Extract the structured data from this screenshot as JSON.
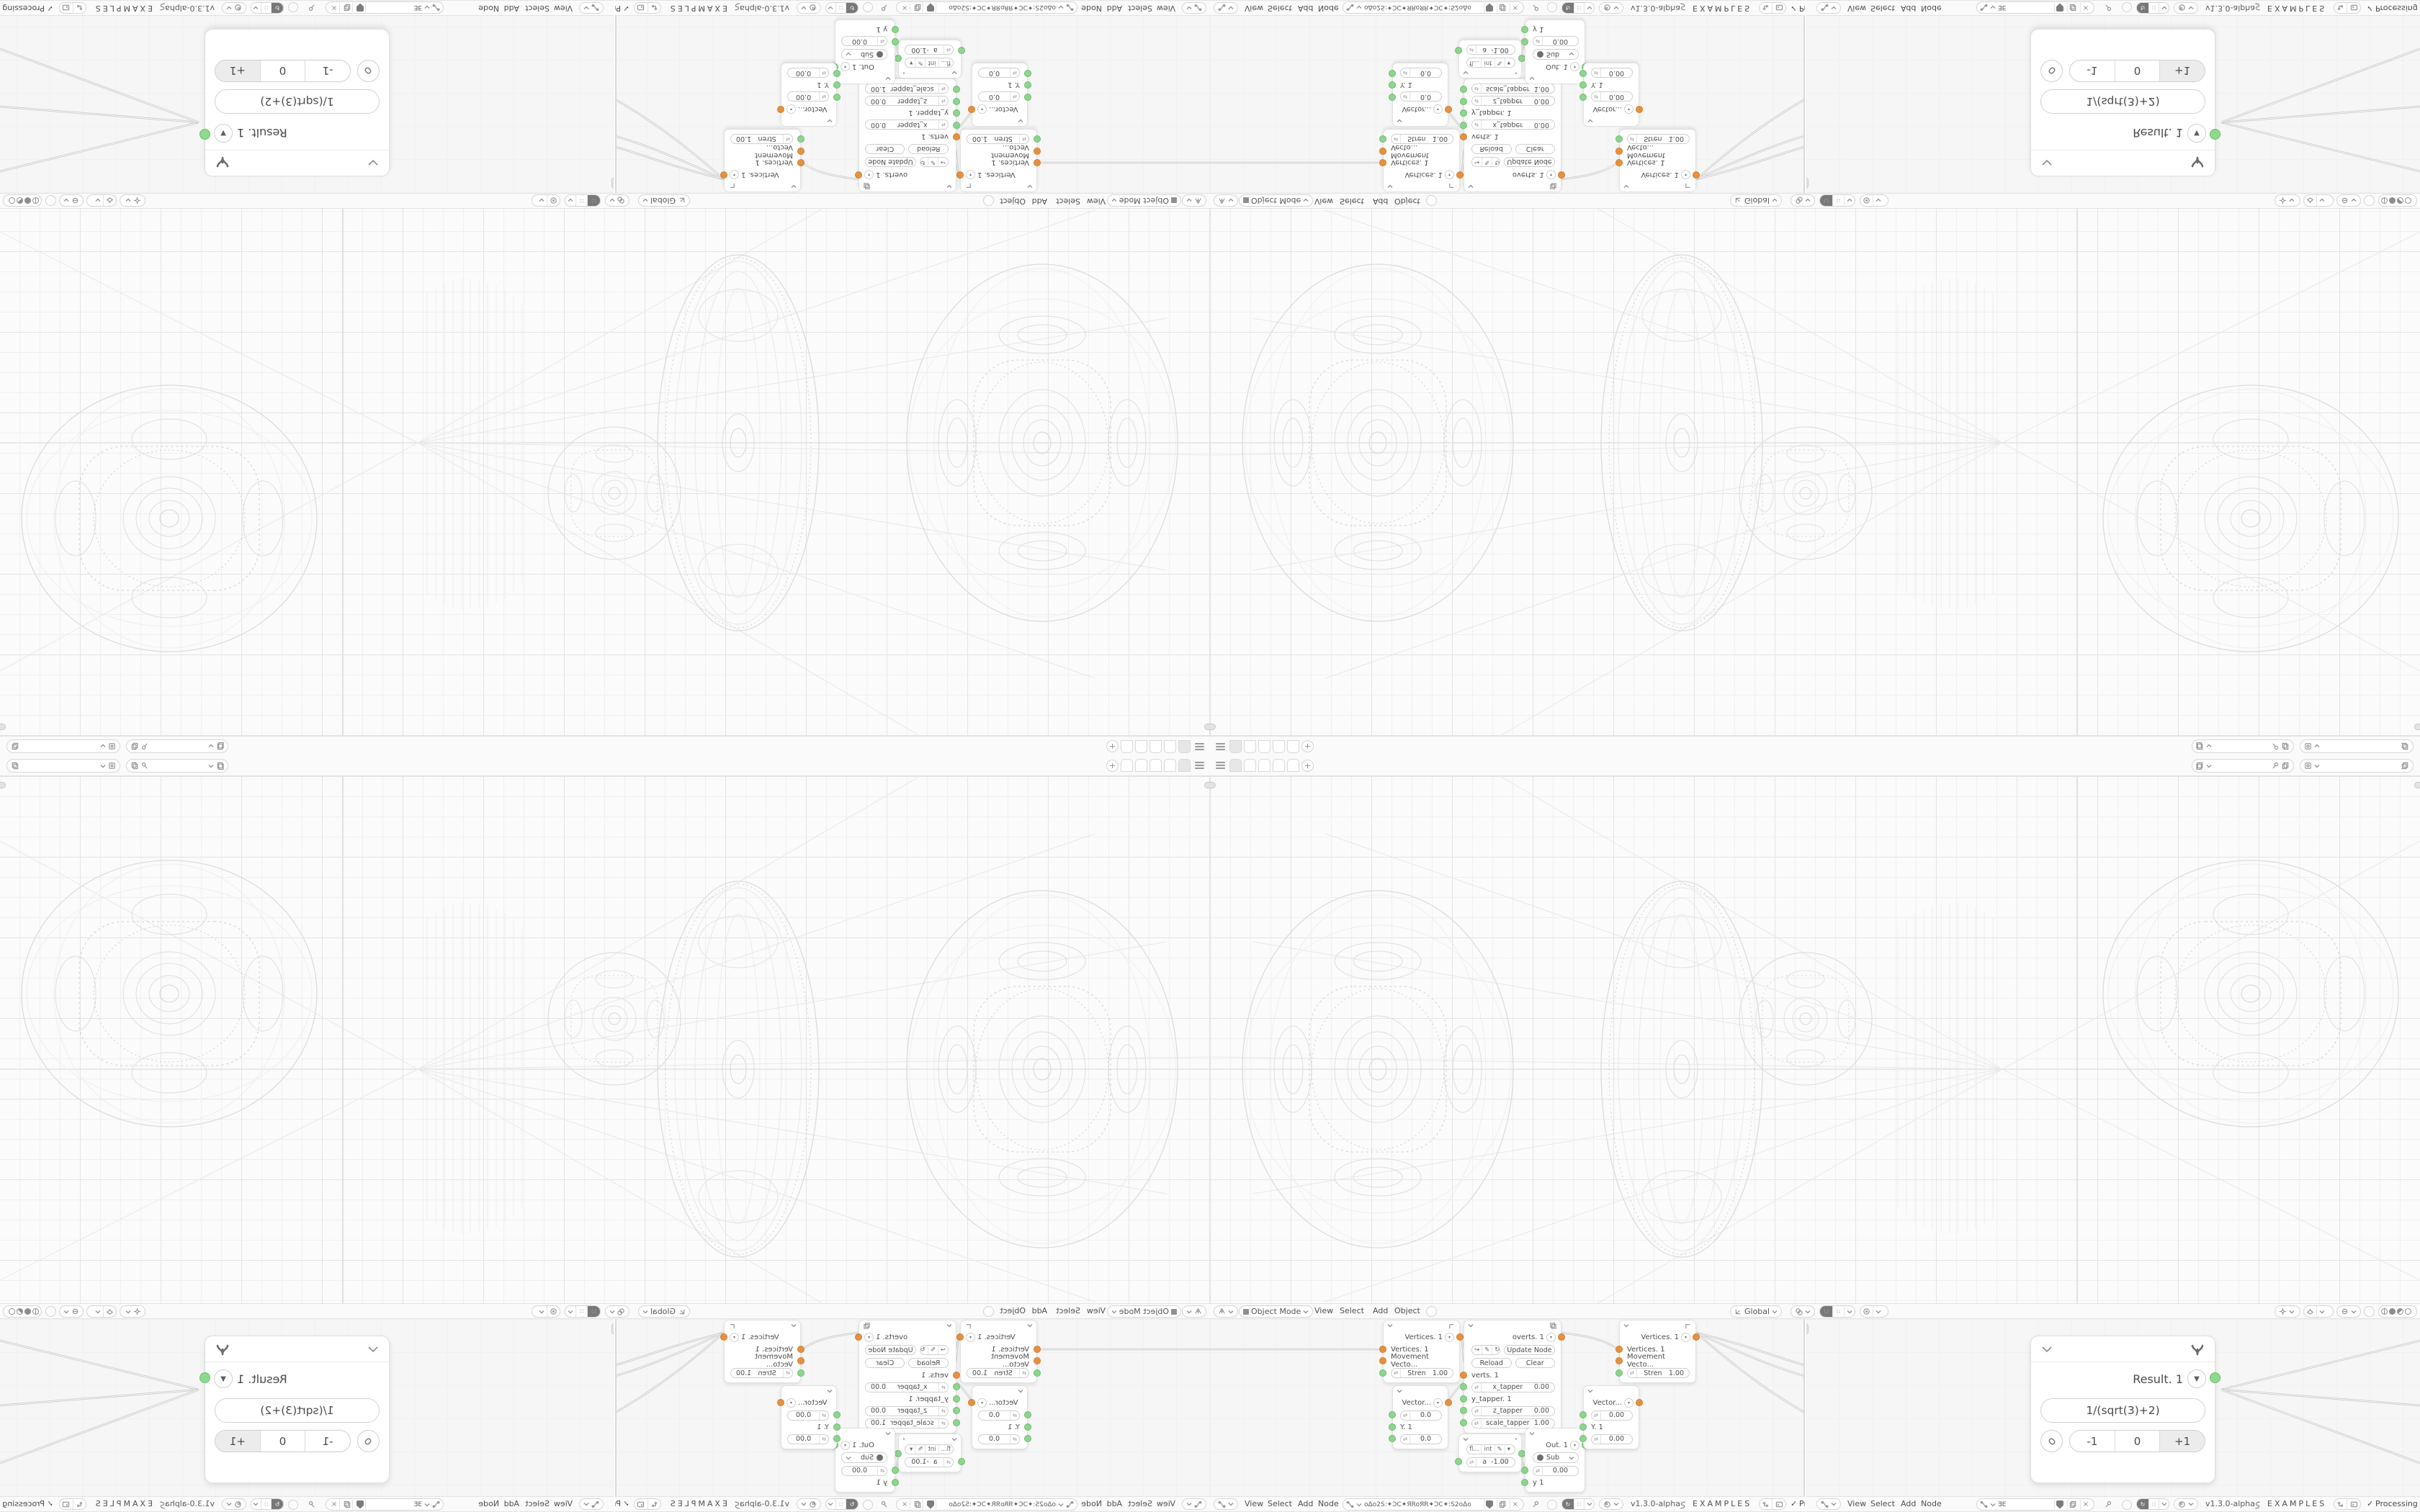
{
  "topbar": {
    "scene_field_value": "",
    "view_layer_field_value": "",
    "workspace_add_label": "+"
  },
  "viewport_header": {
    "mode_label": "Object Mode",
    "menus": [
      "View",
      "Select",
      "Add",
      "Object"
    ],
    "orientation_label": "Global"
  },
  "node_header": {
    "menus": [
      "View",
      "Select",
      "Add",
      "Node"
    ],
    "version": "v1.3.0-alpha",
    "examples_label": "EXAMPLES",
    "status_label": "Processing",
    "check": "✓"
  },
  "node_header_left": {
    "tree_name": "oΔo2S:✦ƆC✦ЯRoЯR✦ƆC✦:S2oΔo"
  },
  "node_header_right": {
    "tree_name": "ƎE"
  },
  "nodes": {
    "viewer": {
      "title": "Vertices. 1",
      "input1": "Vertices. 1",
      "input2": "Movement Vecto...",
      "slider_label": "Stren",
      "slider_value": "1.00"
    },
    "script": {
      "title": "overts. 1",
      "update_label": "Update Node",
      "reload_label": "Reload",
      "clear_label": "Clear",
      "socket_label": "verts. 1",
      "x_label": "x_tapper",
      "x_value": "0.00",
      "y_label": "y_tapper. 1",
      "z_label": "z_tapper",
      "z_value": "0.00",
      "scale_label": "scale_tapper",
      "scale_value": "1.00"
    },
    "vector": {
      "title": "Vector...",
      "v1": "0.0",
      "y_label": "Y. 1",
      "v2": "0.0"
    },
    "vector2": {
      "title": "Vector...",
      "v1": "0.00",
      "y_label": "Y. 1",
      "v2": "0.00"
    },
    "number": {
      "seg1": "fl...",
      "seg2": "int",
      "label": "a",
      "value": "-1.00"
    },
    "out": {
      "title": "Out. 1",
      "op": "Sub",
      "value": "0.00",
      "y_label": "y 1"
    },
    "result": {
      "title": "Result. 1",
      "formula": "1/(sqrt(3)+2)",
      "btn_minus": "-1",
      "btn_zero": "0",
      "btn_plus": "+1"
    }
  },
  "colors": {
    "socket_orange": "#e79140",
    "socket_green": "#8fd48f",
    "accent_dark": "#787878"
  }
}
